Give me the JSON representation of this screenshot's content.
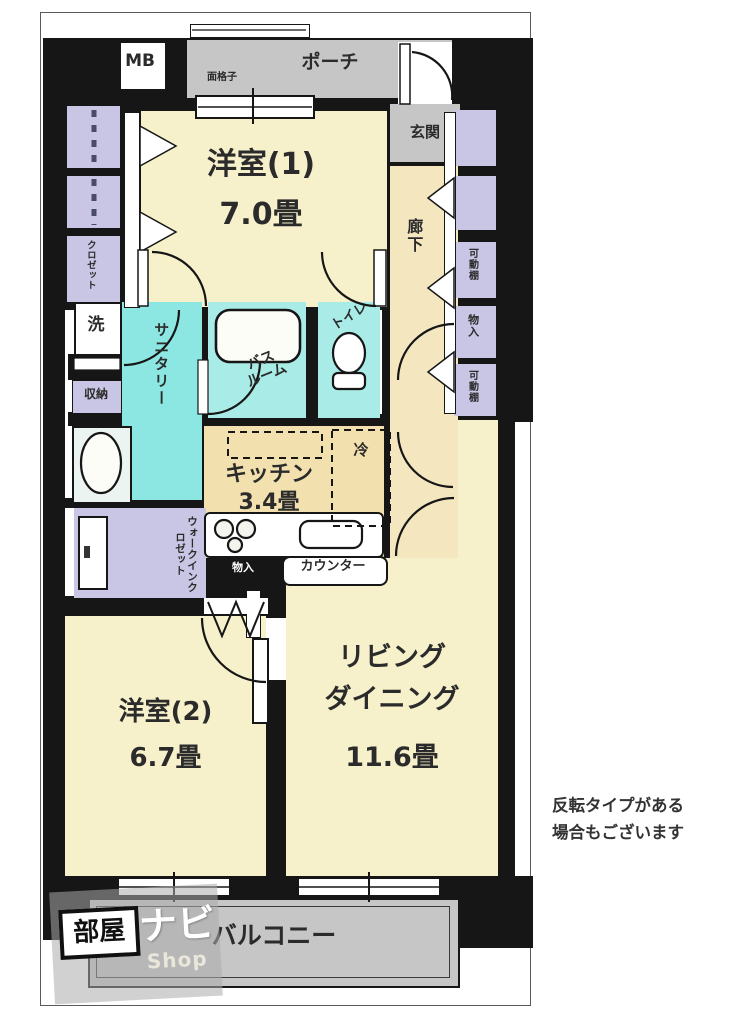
{
  "palette": {
    "wall": "#161616",
    "room_cream": "#f7f1cb",
    "kitchen_tan": "#f2e0ae",
    "corridor_tan": "#f4e7c0",
    "sanitary_cyan": "#8ce6e2",
    "bath_cyan": "#a9ebe6",
    "closet_lavender": "#c9c5e4",
    "outdoor_gray": "#c6c6c7"
  },
  "top": {
    "mb": "MB",
    "porch": "ポーチ",
    "grille": "面格子",
    "entrance": "玄関"
  },
  "corridor": {
    "label": "廊下"
  },
  "right_column": {
    "shelf1": "可動棚",
    "storage": "物入",
    "shelf2": "可動棚"
  },
  "left_column": {
    "closet": "クロゼット"
  },
  "water": {
    "laundry": "洗",
    "storage": "収納",
    "sanitary": "サニタリー",
    "bath_l1": "バス",
    "bath_l2": "ルーム",
    "toilet": "トイレ"
  },
  "kitchen": {
    "name": "キッチン",
    "size": "3.4畳",
    "fridge": "冷",
    "counter": "カウンター",
    "storage": "物入"
  },
  "wic": {
    "label": "ウォークインクロゼット"
  },
  "rooms": {
    "r1_name": "洋室(1)",
    "r1_size": "7.0畳",
    "r2_name": "洋室(2)",
    "r2_size": "6.7畳",
    "ld_l1": "リビング",
    "ld_l2": "ダイニング",
    "ld_size": "11.6畳"
  },
  "balcony": {
    "label": "バルコニー"
  },
  "note": {
    "line1": "反転タイプがある",
    "line2": "場合もございます"
  },
  "watermark": {
    "p1": "部屋",
    "p2": "ナビ",
    "p3": "Shop"
  }
}
